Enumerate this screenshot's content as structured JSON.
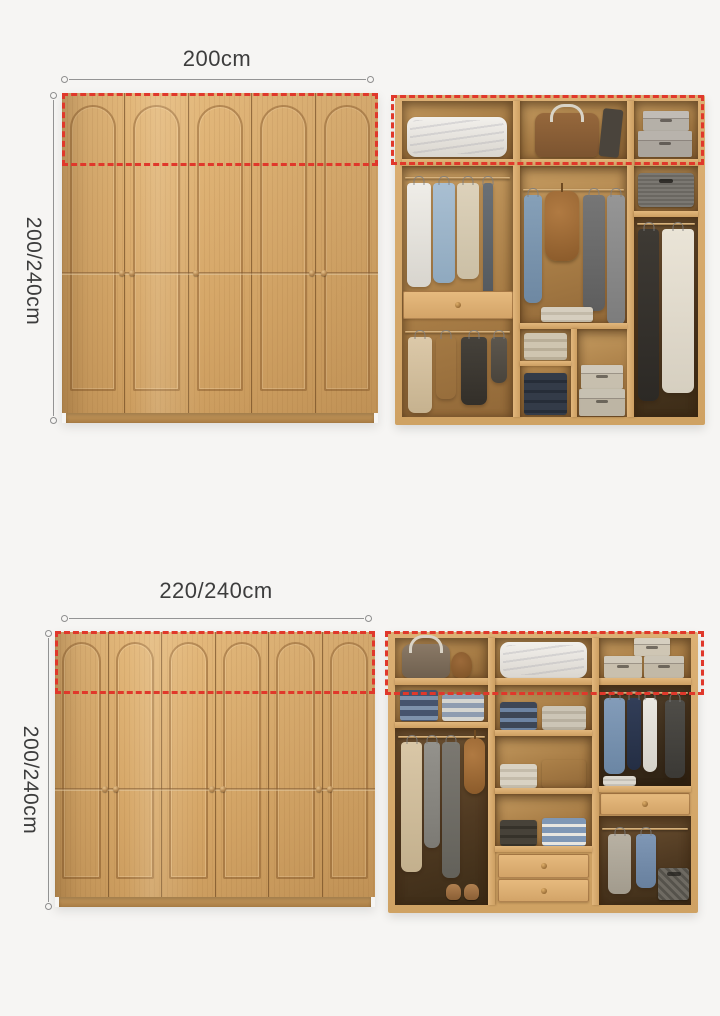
{
  "page": {
    "background": "#f6f5f3"
  },
  "palette": {
    "dimension_line": "#929292",
    "dimension_text": "#3d3d3d",
    "highlight_dashed": "#e0382b",
    "wood_door": "#d9ab6e",
    "wood_groove": "#8f6134",
    "wood_frame": "#d8aa6f",
    "cavity_back": "#a87d46"
  },
  "sections": [
    {
      "width_label": "200cm",
      "height_label": "200/240cm",
      "front": {
        "doors": 5
      },
      "interior": {
        "top_shelf": [
          "folded-duvet",
          "duffel-bag",
          "stacked-storage-boxes"
        ],
        "compartments": [
          "hanging-shirts",
          "drawer",
          "hanging-clothes",
          "hanging-jeans",
          "backpack",
          "hanging-coats",
          "folded-knitwear",
          "folded-jeans",
          "storage-boxes",
          "fabric-box",
          "long-coat",
          "long-dress"
        ]
      }
    },
    {
      "width_label": "220/240cm",
      "height_label": "200/240cm",
      "front": {
        "doors": 6
      },
      "interior": {
        "top_shelf": [
          "duffel-bag",
          "hat",
          "folded-duvet",
          "stacked-storage-boxes"
        ],
        "compartments": [
          "folded-jeans",
          "hanging-clothes",
          "backpack",
          "shoes",
          "folded-stacks",
          "two-drawers",
          "hanging-shirts",
          "drawer",
          "storage-basket"
        ]
      }
    }
  ]
}
